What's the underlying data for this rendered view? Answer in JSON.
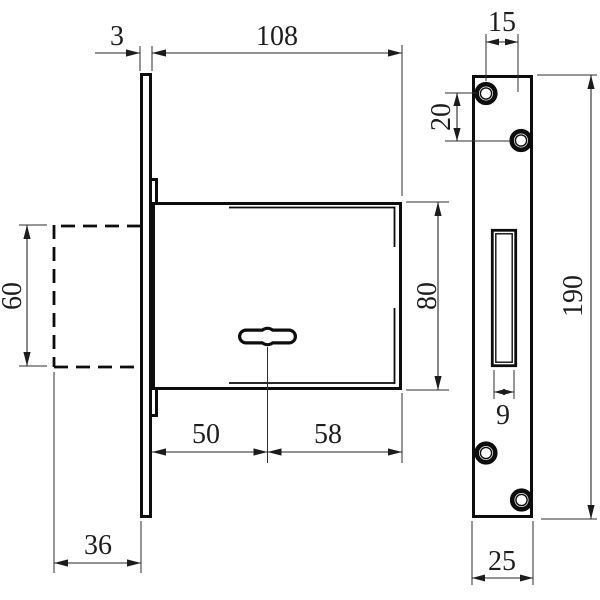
{
  "dims": {
    "faceplate_thickness": "3",
    "body_length": "108",
    "recess_height": "60",
    "body_height": "80",
    "keyhole_setback": "50",
    "keyhole_to_back": "58",
    "recess_depth": "36",
    "hole_offset_x": "15",
    "hole_offset_y": "20",
    "plate_height": "190",
    "slot_width": "9",
    "plate_width": "25"
  }
}
